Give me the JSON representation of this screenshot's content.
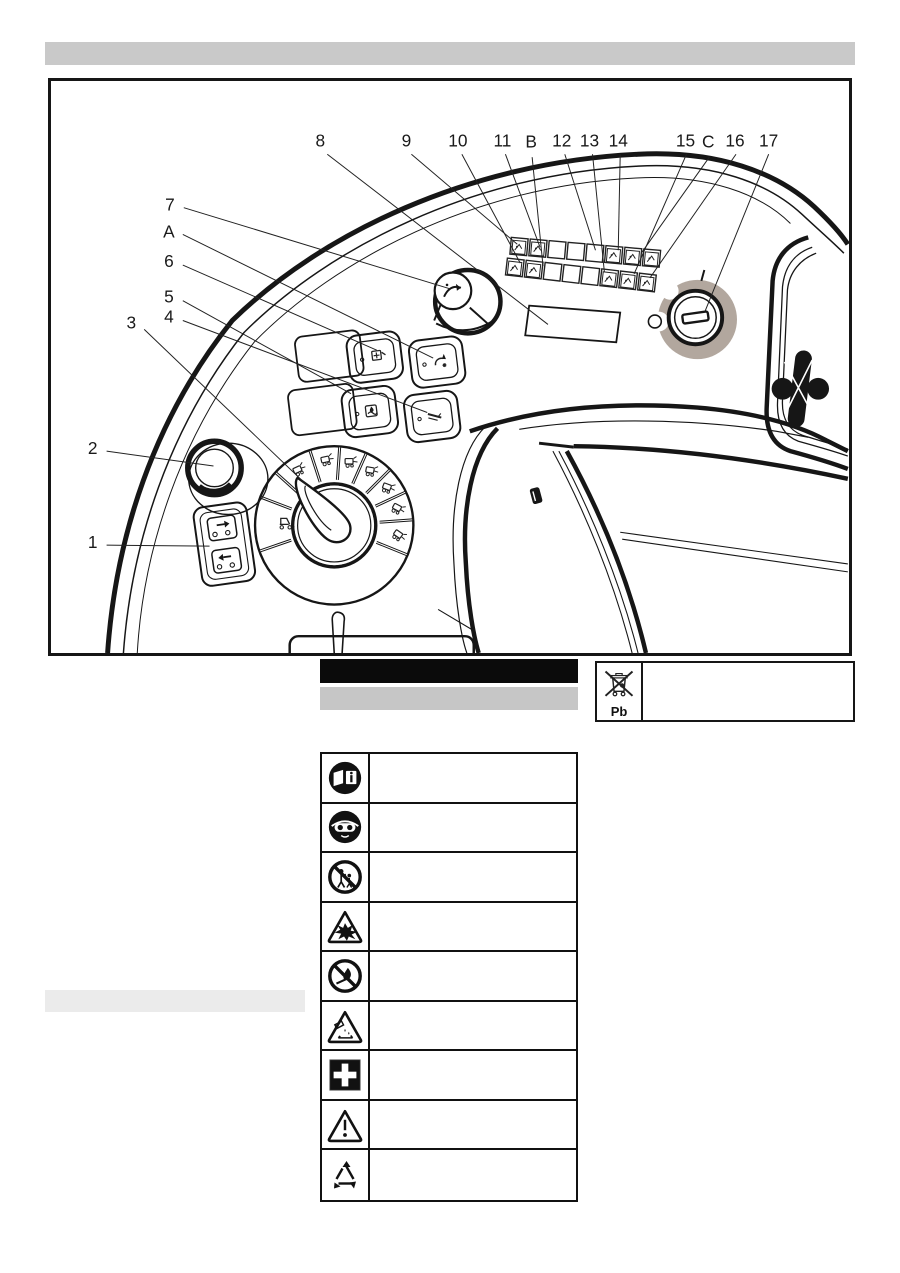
{
  "page": {
    "background": "#ffffff"
  },
  "header_bar": {
    "style": "redacted-heading",
    "color": "#c9c9c9"
  },
  "figure": {
    "description_style": "technical-line-drawing-of-operating-console",
    "key_switch_accent": "#b2a79e",
    "callouts": [
      {
        "label": "8"
      },
      {
        "label": "9"
      },
      {
        "label": "10"
      },
      {
        "label": "11"
      },
      {
        "label": "B"
      },
      {
        "label": "12"
      },
      {
        "label": "13"
      },
      {
        "label": "14"
      },
      {
        "label": "15"
      },
      {
        "label": "C"
      },
      {
        "label": "16"
      },
      {
        "label": "17"
      },
      {
        "label": "7"
      },
      {
        "label": "A"
      },
      {
        "label": "6"
      },
      {
        "label": "5"
      },
      {
        "label": "4"
      },
      {
        "label": "3"
      },
      {
        "label": "2"
      },
      {
        "label": "1"
      }
    ]
  },
  "caption_bars": {
    "black_bar": {
      "style": "inverted-heading",
      "color": "#0b0b0b"
    },
    "gray_bar": {
      "style": "subheading",
      "color": "#c6c6c6"
    }
  },
  "battery_note": {
    "symbol": "crossed-out-waste-bin-icon",
    "chemical_label": "Pb"
  },
  "section_bar": {
    "style": "subheading",
    "color": "#ebebeb"
  },
  "safety_table": {
    "rows": [
      {
        "symbol": "operating-instructions-icon"
      },
      {
        "symbol": "eye-protection-icon"
      },
      {
        "symbol": "keep-children-away-icon"
      },
      {
        "symbol": "explosion-hazard-icon"
      },
      {
        "symbol": "no-open-flame-icon"
      },
      {
        "symbol": "corrosive-hazard-icon"
      },
      {
        "symbol": "first-aid-icon"
      },
      {
        "symbol": "general-warning-icon"
      },
      {
        "symbol": "recycling-icon"
      }
    ]
  }
}
